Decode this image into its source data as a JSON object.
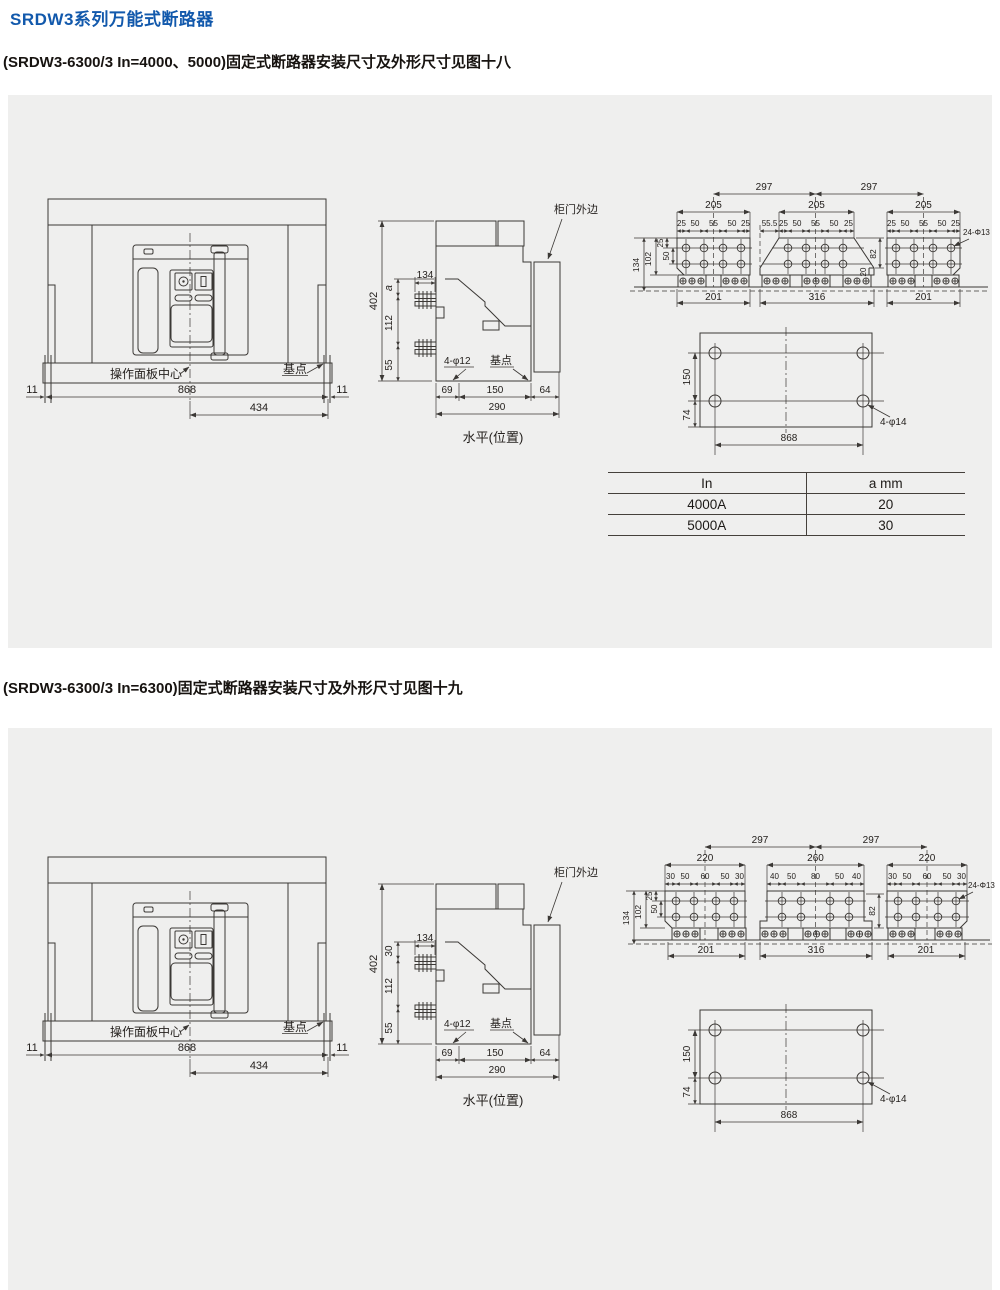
{
  "page": {
    "title": "SRDW3系列万能式断路器",
    "heading_fig18": "(SRDW3-6300/3 In=4000、5000)固定式断路器安装尺寸及外形尺寸见图十八",
    "heading_fig19": "(SRDW3-6300/3 In=6300)固定式断路器安装尺寸及外形尺寸见图十九",
    "title_color": "#1259ac",
    "panel_bg": "#efefee",
    "line_color": "#3b3835"
  },
  "front_view": {
    "panel_center_label": "操作面板中心",
    "base_point_label": "基点",
    "dims": {
      "side_left": "11",
      "total": "868",
      "side_right": "11",
      "half": "434"
    }
  },
  "side_view": {
    "door_label": "柜门外边",
    "holes_label": "4-φ12",
    "base_point_label": "基点",
    "caption": "水平(位置)",
    "a_fig18": "a",
    "a_fig19": "30",
    "dims": {
      "height": "402",
      "depth": "134",
      "span_mid": "112",
      "span_low": "55",
      "front": "69",
      "mid": "150",
      "rear": "64",
      "total": "290"
    }
  },
  "terminal_fig18": {
    "pitch_left": "297",
    "pitch_right": "297",
    "w1": "205",
    "w2": "205",
    "w3": "205",
    "s1": [
      "25",
      "50",
      "55",
      "50",
      "25"
    ],
    "s2_prefix": "55.5",
    "s2": [
      "25",
      "50",
      "55",
      "50",
      "25"
    ],
    "s3": [
      "25",
      "50",
      "55",
      "50",
      "25"
    ],
    "v134": "134",
    "v102": "102",
    "v25": "25",
    "v50": "50",
    "v82": "82",
    "v20": "20",
    "holes_label": "24-Φ13",
    "b1": "201",
    "b2": "316",
    "b3": "201"
  },
  "terminal_fig19": {
    "pitch_left": "297",
    "pitch_right": "297",
    "w1": "220",
    "w2": "260",
    "w3": "220",
    "s1": [
      "30",
      "50",
      "60",
      "50",
      "30"
    ],
    "s2": [
      "40",
      "50",
      "80",
      "50",
      "40"
    ],
    "s3": [
      "30",
      "50",
      "60",
      "50",
      "30"
    ],
    "v134": "134",
    "v102": "102",
    "v25": "25",
    "v50": "50",
    "v82": "82",
    "holes_label": "24-Φ13",
    "b1": "201",
    "b2": "316",
    "b3": "201"
  },
  "mounting": {
    "v150": "150",
    "v74": "74",
    "width": "868",
    "holes_label": "4-φ14"
  },
  "spec_table": {
    "col1": "In",
    "col2": "a mm",
    "rows": [
      {
        "in": "4000A",
        "a": "20"
      },
      {
        "in": "5000A",
        "a": "30"
      }
    ]
  }
}
